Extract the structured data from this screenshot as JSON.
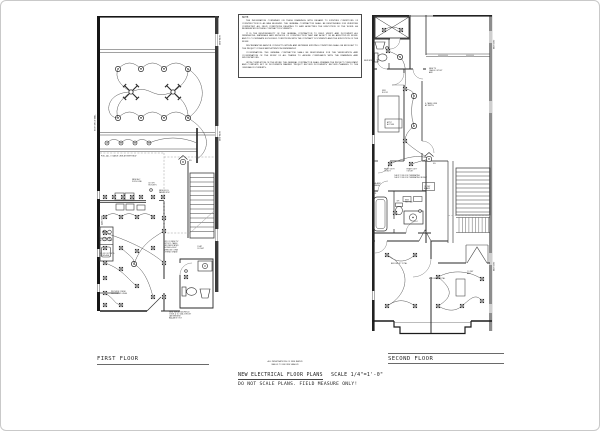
{
  "page": {
    "background": "#ffffff",
    "border_color": "#c9c9c9",
    "ink_color": "#1f1f1f",
    "gray_wall_color": "#8d8d8d"
  },
  "note_box": {
    "title": "NOTE:",
    "paragraphs": [
      "THE INFORMATION CONTAINED ON THESE DRAWINGS WITH REGARD TO EXISTING CONDITIONS OF CONSTRUCTION IS AS WAS BELIEVED. THE GENERAL CONTRACTOR SHALL BE RESPONSIBLE FOR VERIFYING COMPLETELY ALL FIELD CONDITIONS RELATING TO AND AFFECTING THE EXECUTION OF THE WORK, AS REFERENCED IN THESE CONTRACT DOCUMENTS.",
      "IT IS THE RESPONSIBILITY OF THE GENERAL CONTRACTOR TO FIELD VERIFY AND DOCUMENT ALL DIMENSIONS, MATERIALS AND METHODS OF CONSTRUCTION THAT MAY AFFECT OR BE AFFECTED BY WORK, AND TO COORDINATE SUCH FIELD CONDITIONS WITH THE CONTRACT DOCUMENTS AND THE EXECUTION OF THE WORK.",
      "DISCREPANCIES AND/OR CONFLICTS WITHIN AND BETWEEN EXISTING CONDITIONS SHALL BE BROUGHT TO THE PROJECT CONSULTANT ATTENTION IMMEDIATELY.",
      "COORDINATION: THE GENERAL CONTRACTOR SHALL BE RESPONSIBLE FOR THE VERIFICATION AND COORDINATION OF THE WORK OF ALL TRADES TO ASSURE COMPLIANCE WITH THE DRAWINGS AND SPECIFICATIONS.",
      "UPON COMPLETION OF THE WORK, THE GENERAL CONTRACTOR SHALL PREPARE THE PROJECT CONSULTANT AND COMPLETE SET OF DOCUMENTS MARKED 'PROJECT RECORD DOCUMENTS' RECORD CHANGES TO THE ORIGINAL DOCUMENTS."
    ]
  },
  "titles": {
    "first_floor": "FIRST FLOOR",
    "second_floor": "SECOND FLOOR",
    "main_title": "NEW ELECTRICAL FLOOR PLANS",
    "scale": "SCALE 1/4\"=1'-0\"",
    "warning": "DO NOT SCALE PLANS. FIELD MEASURE ONLY!",
    "cert_line1": "ALL PENETRATIONS OF FIRE RATED",
    "cert_line2": "WALLS TO BE FIRE SEALED"
  },
  "first_floor": {
    "fixtures": [
      {
        "k": "light",
        "x": 117,
        "y": 68
      },
      {
        "k": "light",
        "x": 140,
        "y": 68
      },
      {
        "k": "light",
        "x": 163,
        "y": 68
      },
      {
        "k": "light",
        "x": 187,
        "y": 68
      },
      {
        "k": "light",
        "x": 117,
        "y": 117
      },
      {
        "k": "light",
        "x": 140,
        "y": 117
      },
      {
        "k": "light",
        "x": 163,
        "y": 117
      },
      {
        "k": "light",
        "x": 187,
        "y": 117
      },
      {
        "k": "light",
        "x": 133,
        "y": 263
      },
      {
        "k": "fan",
        "x": 130,
        "y": 91
      },
      {
        "k": "fan",
        "x": 172,
        "y": 91
      },
      {
        "k": "lightsm",
        "x": 106,
        "y": 142
      },
      {
        "k": "lightsm",
        "x": 120,
        "y": 142
      },
      {
        "k": "lightsm",
        "x": 134,
        "y": 142
      },
      {
        "k": "lightsm",
        "x": 148,
        "y": 142
      },
      {
        "k": "sd",
        "x": 182,
        "y": 161
      },
      {
        "k": "outlet",
        "x": 104,
        "y": 196
      },
      {
        "k": "outlet",
        "x": 113,
        "y": 196
      },
      {
        "k": "outlet",
        "x": 122,
        "y": 196
      },
      {
        "k": "outlet",
        "x": 131,
        "y": 196
      },
      {
        "k": "outlet",
        "x": 140,
        "y": 196
      },
      {
        "k": "outlet",
        "x": 152,
        "y": 196
      },
      {
        "k": "outlet",
        "x": 162,
        "y": 196
      },
      {
        "k": "outlet",
        "x": 104,
        "y": 216
      },
      {
        "k": "outlet",
        "x": 120,
        "y": 216
      },
      {
        "k": "outlet",
        "x": 136,
        "y": 216
      },
      {
        "k": "outlet",
        "x": 152,
        "y": 216
      },
      {
        "k": "outlet",
        "x": 163,
        "y": 217
      },
      {
        "k": "outlet",
        "x": 104,
        "y": 232
      },
      {
        "k": "outlet",
        "x": 104,
        "y": 247
      },
      {
        "k": "outlet",
        "x": 104,
        "y": 262
      },
      {
        "k": "outlet",
        "x": 104,
        "y": 277
      },
      {
        "k": "outlet",
        "x": 104,
        "y": 292
      },
      {
        "k": "outlet",
        "x": 104,
        "y": 304
      },
      {
        "k": "outlet",
        "x": 120,
        "y": 247
      },
      {
        "k": "outlet",
        "x": 136,
        "y": 250
      },
      {
        "k": "outlet",
        "x": 152,
        "y": 247
      },
      {
        "k": "outlet",
        "x": 163,
        "y": 230
      },
      {
        "k": "outlet",
        "x": 163,
        "y": 262
      },
      {
        "k": "outlet",
        "x": 120,
        "y": 268
      },
      {
        "k": "outlet",
        "x": 136,
        "y": 285
      },
      {
        "k": "outlet",
        "x": 152,
        "y": 296
      },
      {
        "k": "outlet",
        "x": 163,
        "y": 296
      },
      {
        "k": "outlet",
        "x": 120,
        "y": 304
      },
      {
        "k": "outlet",
        "x": 185,
        "y": 276
      },
      {
        "k": "gfi",
        "x": 150,
        "y": 189
      },
      {
        "k": "gfi",
        "x": 185,
        "y": 270
      }
    ],
    "annotations": [
      {
        "x": 100,
        "y": 155.5,
        "t": "PULL ALL 3 CABLE LINE AT BSMT BLW",
        "fs": 1.9
      },
      {
        "x": 131,
        "y": 179,
        "t": "NEW A/C|220V LINE",
        "fs": 1.9
      },
      {
        "x": 147,
        "y": 182.5,
        "t": "(2) GFI|OUTLETS",
        "fs": 1.9
      },
      {
        "x": 158,
        "y": 190,
        "t": "NEW SQ D|PANEL BOX",
        "fs": 1.9
      },
      {
        "x": 162.5,
        "y": 241,
        "t": "ADD (1) NEW TV|OUTLET, CABLE|AND DEDICATED|PHONE & ELEC|WIRED IN CONN|EXTEND CHASE",
        "fs": 1.8
      },
      {
        "x": 98.5,
        "y": 238,
        "t": "NEW RANGE|W/ HOOD ABV",
        "fs": 1.8
      },
      {
        "x": 98.5,
        "y": 253,
        "t": "(2) GFI OUTLETS|AT SPLASH",
        "fs": 1.8
      },
      {
        "x": 110,
        "y": 291,
        "t": "PROVIDE 2 NEW|DEDICATED LINES",
        "fs": 1.8
      },
      {
        "x": 168,
        "y": 311.5,
        "t": "NEW WIRING AS REQD|CODE & (1) 20A CIRCUIT|(AS NEEDED)|BALANCE OUT",
        "fs": 1.8
      },
      {
        "x": 102,
        "y": 224,
        "t": "KITCHEN",
        "fs": 2.2,
        "rot": -90
      },
      {
        "x": 188,
        "y": 160,
        "t": "SD",
        "fs": 1.9
      },
      {
        "x": 196,
        "y": 246,
        "t": "COAT|CLOSET",
        "fs": 1.8
      },
      {
        "x": 219.5,
        "y": 44,
        "t": "NEW WDW",
        "fs": 1.8,
        "rot": -90
      },
      {
        "x": 219.5,
        "y": 140,
        "t": "NEW WDW",
        "fs": 1.8,
        "rot": -90
      },
      {
        "x": 94.5,
        "y": 130,
        "t": "EXIST BRICK WALL",
        "fs": 1.8,
        "rot": -90
      }
    ]
  },
  "second_floor": {
    "fixtures": [
      {
        "k": "outlet",
        "x": 383,
        "y": 29
      },
      {
        "k": "outlet",
        "x": 400,
        "y": 29
      },
      {
        "k": "outlet",
        "x": 387,
        "y": 50
      },
      {
        "k": "outlet",
        "x": 404,
        "y": 88
      },
      {
        "k": "outlet",
        "x": 404,
        "y": 140
      },
      {
        "k": "outlet",
        "x": 389,
        "y": 163
      },
      {
        "k": "outlet",
        "x": 410,
        "y": 163
      },
      {
        "k": "outlet",
        "x": 394,
        "y": 212
      },
      {
        "k": "outlet",
        "x": 386,
        "y": 254
      },
      {
        "k": "outlet",
        "x": 414,
        "y": 254
      },
      {
        "k": "outlet",
        "x": 386,
        "y": 305
      },
      {
        "k": "outlet",
        "x": 414,
        "y": 305
      },
      {
        "k": "outlet",
        "x": 437,
        "y": 276
      },
      {
        "k": "outlet",
        "x": 481,
        "y": 278
      },
      {
        "k": "outlet",
        "x": 437,
        "y": 305
      },
      {
        "k": "outlet",
        "x": 461,
        "y": 305
      },
      {
        "k": "outlet",
        "x": 481,
        "y": 300
      },
      {
        "k": "light",
        "x": 399,
        "y": 56
      },
      {
        "k": "light",
        "x": 413,
        "y": 95
      },
      {
        "k": "light",
        "x": 413,
        "y": 125
      },
      {
        "k": "sd",
        "x": 428,
        "y": 158
      },
      {
        "k": "gfi",
        "x": 386,
        "y": 47
      },
      {
        "k": "gfi",
        "x": 419,
        "y": 210
      }
    ],
    "annotations": [
      {
        "x": 428,
        "y": 68,
        "t": "NEW TV|CABLE OUTLET|ABV",
        "fs": 1.8
      },
      {
        "x": 424,
        "y": 103,
        "t": "S CABLE LINE|AT DEPTH",
        "fs": 1.8
      },
      {
        "x": 386,
        "y": 122,
        "t": "ATTIC|ACCESS",
        "fs": 1.8
      },
      {
        "x": 381,
        "y": 90,
        "t": "3RD|ROOM",
        "fs": 1.8
      },
      {
        "x": 383,
        "y": 168.5,
        "t": "HEAVY DUTY|OUTLET",
        "fs": 1.7
      },
      {
        "x": 405.5,
        "y": 168.5,
        "t": "HEAVY DUTY|OUTLET",
        "fs": 1.7
      },
      {
        "x": 393,
        "y": 175,
        "t": "CHECK CODE FOR TERMINATING|CHECK CODE FOR TERMINATING IN BSMT",
        "fs": 1.6
      },
      {
        "x": 373.5,
        "y": 183,
        "t": "ALARM|PANEL",
        "fs": 1.7
      },
      {
        "x": 372.5,
        "y": 193,
        "t": "SD",
        "fs": 1.9
      },
      {
        "x": 423,
        "y": 186,
        "t": "CO DET|BOARD",
        "fs": 1.7
      },
      {
        "x": 395.5,
        "y": 200.5,
        "t": "GFI",
        "fs": 1.7
      },
      {
        "x": 404,
        "y": 199.5,
        "t": "NEW|MED CAB",
        "fs": 1.6
      },
      {
        "x": 390,
        "y": 263,
        "t": "BED RM 'B' TOTAL",
        "fs": 1.8
      },
      {
        "x": 428,
        "y": 278,
        "t": "BED RM 'A' TOTAL",
        "fs": 1.8
      },
      {
        "x": 466,
        "y": 271,
        "t": "CO DET|ABV",
        "fs": 1.7
      },
      {
        "x": 432,
        "y": 163,
        "t": "SD",
        "fs": 1.9
      },
      {
        "x": 363,
        "y": 60,
        "t": "NEW WDW",
        "fs": 1.7
      },
      {
        "x": 493.5,
        "y": 48,
        "t": "NEW WDW",
        "fs": 1.7,
        "rot": -90
      },
      {
        "x": 493.5,
        "y": 270,
        "t": "NEW WDW",
        "fs": 1.7,
        "rot": -90
      }
    ]
  }
}
